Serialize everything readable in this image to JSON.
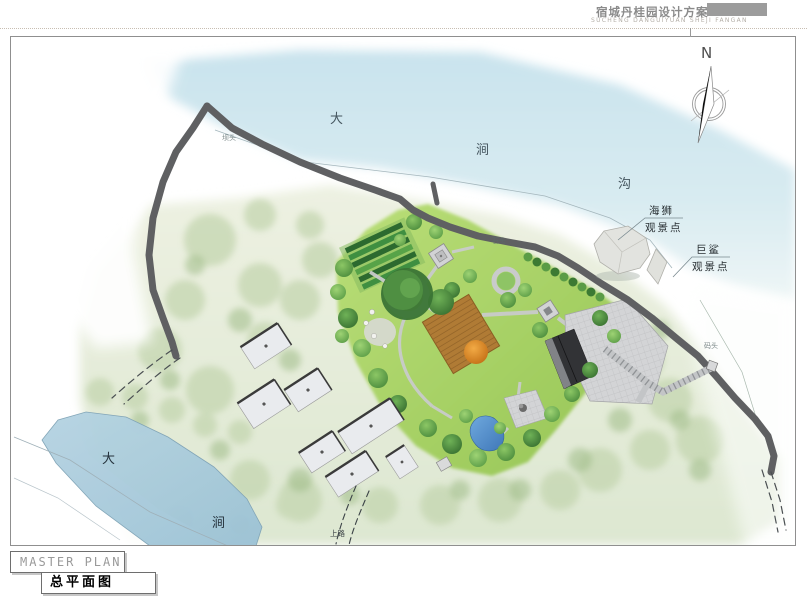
{
  "header": {
    "title": "宿城丹桂园设计方案",
    "subtitle": "SUCHENG DANGUIYUAN SHEJI FANGAN"
  },
  "compass": {
    "north_label": "N"
  },
  "plan": {
    "sheet_title_en": "MASTER PLAN",
    "sheet_title_cn": "总平面图",
    "rivers": {
      "top": {
        "chars": [
          "大",
          "涧",
          "沟"
        ]
      },
      "bottom": {
        "chars": [
          "大",
          "涧"
        ]
      }
    },
    "viewpoints": [
      {
        "line1": "海狮",
        "line2": "观景点"
      },
      {
        "line1": "巨鲨",
        "line2": "观景点"
      }
    ],
    "small_labels": [
      {
        "text": "坝头"
      },
      {
        "text": "石头"
      },
      {
        "text": "码头"
      },
      {
        "text": "上路"
      }
    ]
  },
  "colors": {
    "accent_gray": "#9c9c9c",
    "river_top": "#d3e8ef",
    "river_bottom": "#aecfe0",
    "terrain_green": "#e2ebd6",
    "garden_green": "#a8d45f",
    "road_dark": "#5f6062",
    "deck_brown": "#ad7836",
    "pond_blue": "#4f8ed2",
    "building_white": "#e9ebee",
    "building_dark": "#323336"
  }
}
